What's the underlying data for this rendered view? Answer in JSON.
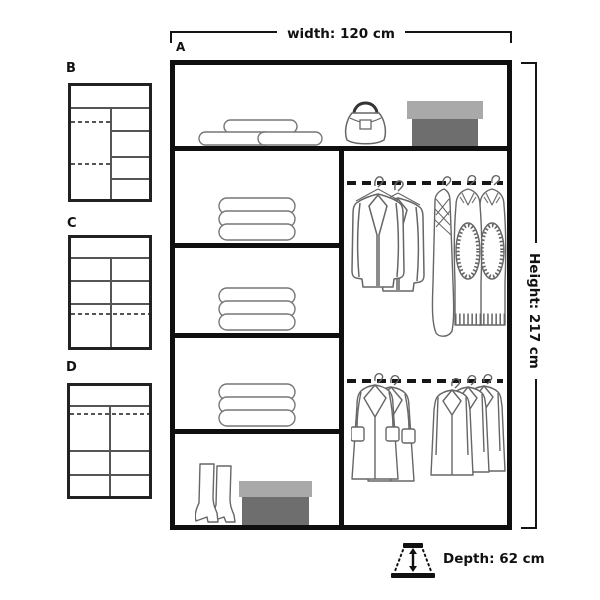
{
  "main_diagram": {
    "label": "A",
    "width_label": "width: 120 cm",
    "height_label": "Height: 217 cm",
    "depth_label": "Depth: 62 cm",
    "contents": {
      "top_shelf": [
        "pillows-icon",
        "handbag-icon",
        "storage-box-icon"
      ],
      "left_column": [
        "folded-clothes-icon",
        "folded-clothes-icon",
        "folded-clothes-icon",
        "boots-icon",
        "storage-box-icon"
      ],
      "right_column": [
        "hanging-rail",
        "jackets-icon",
        "knitwear-icon",
        "hanging-rail",
        "coats-icon",
        "overcoats-icon"
      ]
    }
  },
  "thumbnails": [
    {
      "label": "B"
    },
    {
      "label": "C"
    },
    {
      "label": "D"
    }
  ],
  "colors": {
    "outline": "#0f0f0f",
    "inner_line": "#555555",
    "item_stroke": "#6a6a6a",
    "box_lid": "#a9a9a9",
    "box_body": "#6e6e6e",
    "background": "#ffffff"
  }
}
